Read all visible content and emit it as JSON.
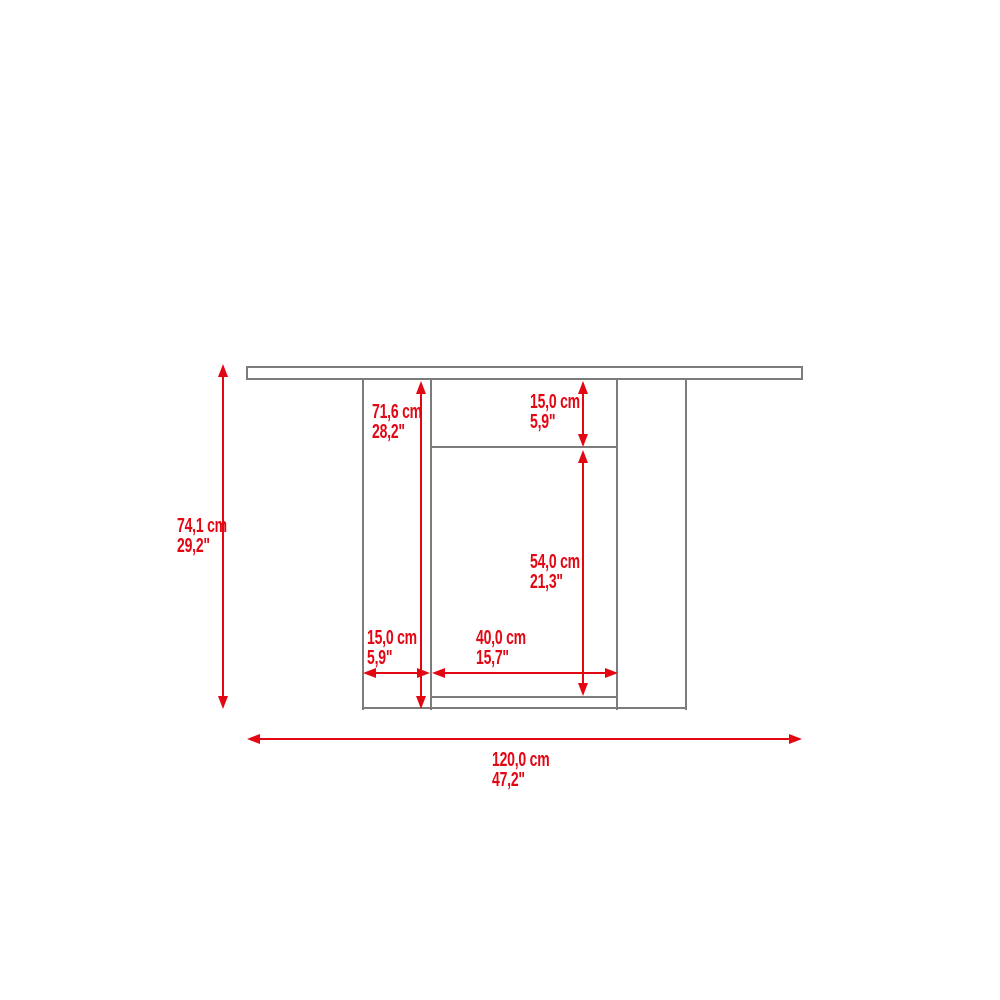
{
  "figure": {
    "type": "furniture-dimension-diagram",
    "view": "front elevation of bar/console table with two side panels, top shelf and bottom shelf"
  },
  "colors": {
    "dimension_red": "#e30613",
    "outline_gray": "#7c7c7c",
    "background": "#ffffff"
  },
  "units": {
    "primary": "cm",
    "secondary": "inches"
  },
  "dimensions": {
    "overall_height": {
      "cm": "74,1 cm",
      "inches": "29,2\""
    },
    "base_height": {
      "cm": "71,6 cm",
      "inches": "28,2\""
    },
    "top_compartment_height": {
      "cm": "15,0 cm",
      "inches": "5,9\""
    },
    "middle_opening_height": {
      "cm": "54,0 cm",
      "inches": "21,3\""
    },
    "side_panel_width": {
      "cm": "15,0 cm",
      "inches": "5,9\""
    },
    "middle_opening_width": {
      "cm": "40,0 cm",
      "inches": "15,7\""
    },
    "overall_width": {
      "cm": "120,0 cm",
      "inches": "47,2\""
    }
  }
}
